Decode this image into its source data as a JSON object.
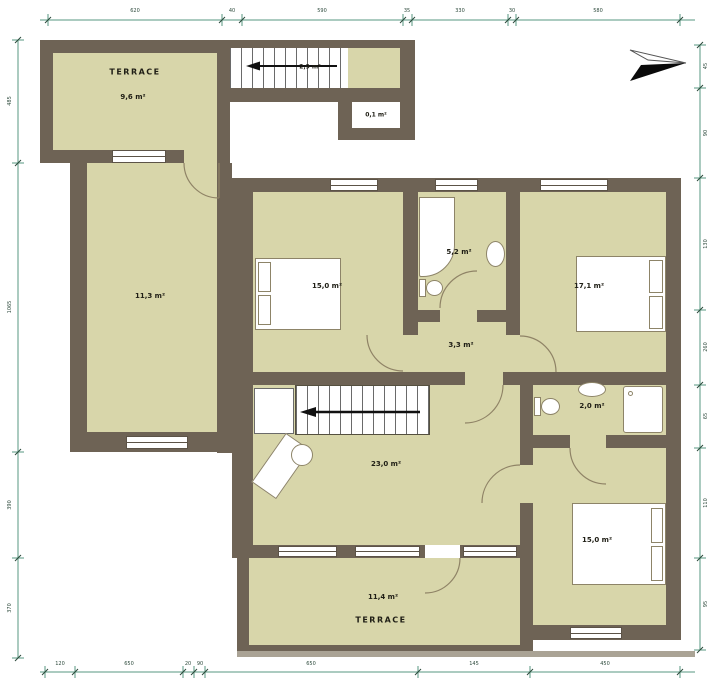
{
  "colors": {
    "wall": "#6e6355",
    "room": "#d8d6aa",
    "dim_line": "#579781"
  },
  "rooms": {
    "terrace_top": {
      "name": "TERRACE",
      "area": "9,6 m²"
    },
    "stairs_top": {
      "area": "2,9 m²"
    },
    "closet": {
      "area": "0,1 m²"
    },
    "room_left": {
      "area": "11,3 m²"
    },
    "bedroom_1": {
      "area": "15,0 m²"
    },
    "bathroom": {
      "area": "5,2 m²"
    },
    "bedroom_2": {
      "area": "17,1 m²"
    },
    "hall": {
      "area": "3,3 m²"
    },
    "wc": {
      "area": "2,0 m²"
    },
    "living": {
      "area": "23,0 m²"
    },
    "bedroom_3": {
      "area": "15,0 m²"
    },
    "terrace_bottom": {
      "name": "TERRACE",
      "area": "11,4 m²"
    }
  },
  "dims": {
    "top": [
      "620",
      "40",
      "590",
      "35",
      "330",
      "30",
      "580"
    ],
    "bottom": [
      "120",
      "650",
      "20",
      "90",
      "650",
      "145",
      "450"
    ],
    "left": [
      "485",
      "1065",
      "390",
      "370"
    ],
    "right": [
      "45",
      "90",
      "130",
      "260",
      "65",
      "110",
      "95"
    ]
  }
}
